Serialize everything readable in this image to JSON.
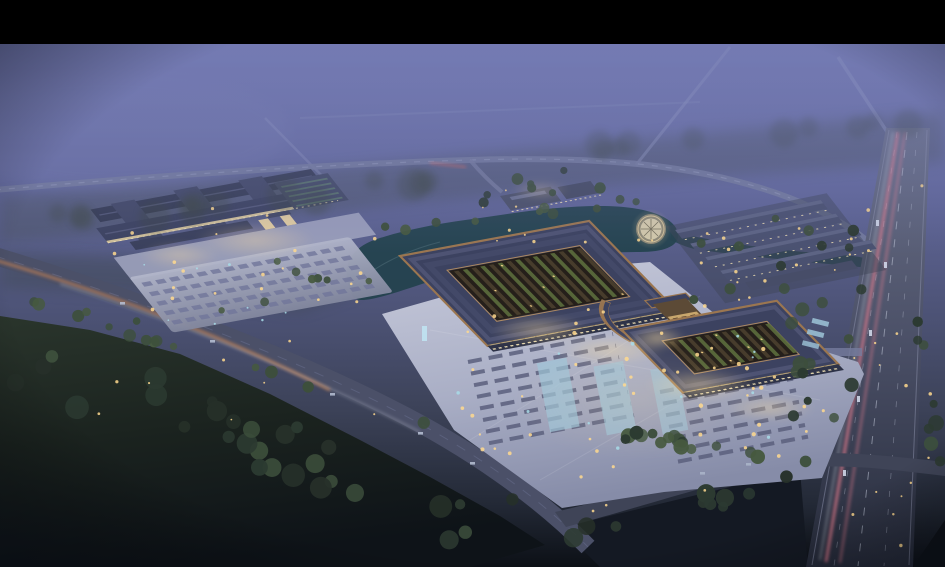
{
  "meta": {
    "description": "Aerial dusk rendering of a large traditional-roof commercial complex with illuminated plazas, parking lots, a pond, a round pavilion, warehouse rows, a forest belt and roads with light trails",
    "time_of_day": "dusk",
    "letterbox_top_px": 44
  },
  "palette": {
    "letterbox": "#000000",
    "sky_top": "#767cb5",
    "sky_mid": "#5d6390",
    "sky_low": "#494f6e",
    "dusk_ground": "#343a4a",
    "forest_mid": "#263029",
    "forest_dark": "#11161a",
    "tree_dark": "#2c3a31",
    "tree_green": "#3d4f3c",
    "tree_bright": "#46593f",
    "mist_tree": "#3a453e",
    "plaza_light": "#c3c6d8",
    "plaza_mid": "#9aa0ba",
    "lot_light": "#aab0c6",
    "lot_mid": "#878da9",
    "roof_dark": "#3c4260",
    "roof_ridge": "#5d6384",
    "copper": "#9b7650",
    "copper_bright": "#c89a62",
    "canopy_lit": "#c9b68d",
    "facade_dark": "#2e3348",
    "facade_lit": "#efe0b4",
    "courtyard_dark": "#251f1a",
    "garden_green": "#5a6b3c",
    "garden_dark": "#4a3f2e",
    "pond_teal": "#24424e",
    "road_gray": "#4b5068",
    "road_light": "#767c9e",
    "distant_road": "#9aa3c8",
    "highway_top": "#6a7088",
    "highway_bottom": "#262b3a",
    "lane_white": "#ccd2e2",
    "trail_pink": "#ef8293",
    "trail_warm": "#d9894e",
    "light_warm": "#ffd98e",
    "light_cool": "#a8dce8",
    "pavilion_lit": "#d3c9ab",
    "glass_blue": "#9ec4d8"
  },
  "scene": {
    "letterbox": {
      "label": "black letterbox bar"
    },
    "sky": {
      "label": "misty dusk sky"
    },
    "distant_roads": {
      "label": "distant roads in haze"
    },
    "upper_road": {
      "label": "upper access road"
    },
    "pond": {
      "label": "landscape pond and canal"
    },
    "forest": {
      "label": "forest belt"
    },
    "main_road": {
      "label": "tree-lined boulevard with car light trails"
    },
    "highway": {
      "label": "arterial highway with pink light trails"
    },
    "cross_road": {
      "label": "south access road"
    },
    "left_complex": {
      "label": "west trade halls with parking lot"
    },
    "north_buildings": {
      "label": "north service buildings"
    },
    "rows_complex": {
      "label": "east warehouse rows"
    },
    "pavilion": {
      "label": "round lakeside pavilion"
    },
    "main_complex": {
      "label": "main market halls with courtyard roofs and gate"
    },
    "plaza": {
      "label": "illuminated forecourt plaza with parking"
    },
    "trees": {
      "label": "trees"
    },
    "lights": {
      "label": "site lighting"
    },
    "cars": {
      "label": "cars"
    }
  }
}
